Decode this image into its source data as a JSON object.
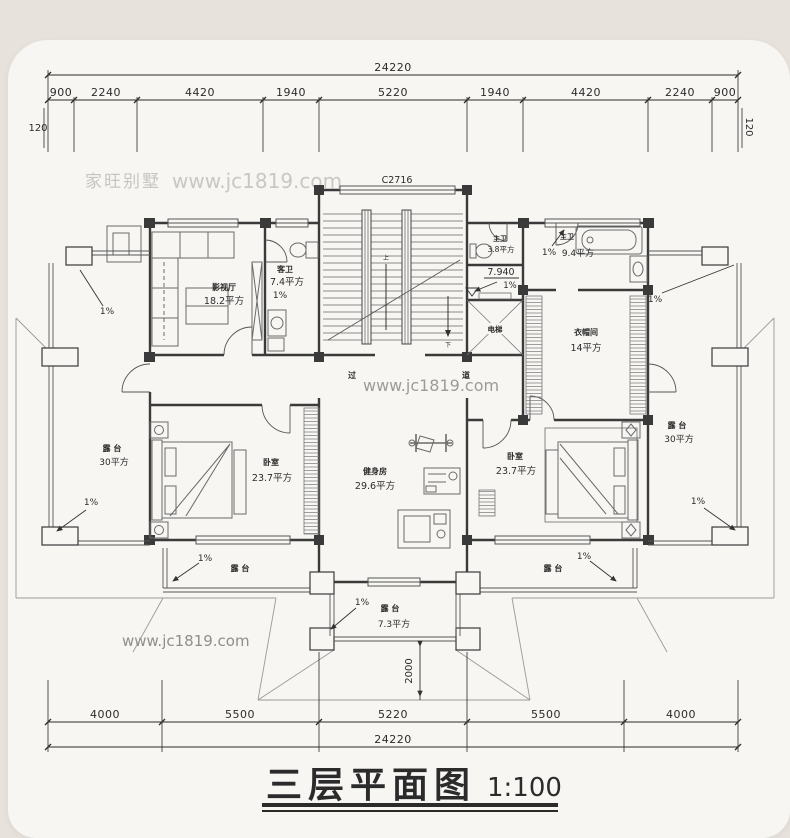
{
  "watermark": {
    "brand": "家旺别墅",
    "site": "www.jc1819.com"
  },
  "top_dims": {
    "total": "24220",
    "segments": [
      "900",
      "2240",
      "4420",
      "1940",
      "5220",
      "1940",
      "4420",
      "2240",
      "900"
    ],
    "edge_left": "120",
    "edge_right": "120"
  },
  "bottom_dims": {
    "total": "24220",
    "segments": [
      "4000",
      "5500",
      "5220",
      "5500",
      "4000"
    ],
    "porch_depth": "2000"
  },
  "plan": {
    "window_label": "C2716",
    "level_mark": "7.940",
    "slope": "1%",
    "stair_up": "上",
    "stair_down": "下",
    "corridor_char_1": "过",
    "corridor_char_2": "道",
    "rooms": {
      "theater": {
        "name": "影视厅",
        "area": "18.2平方"
      },
      "guest_bath": {
        "name": "客卫",
        "area": "7.4平方"
      },
      "small_bath": {
        "name": "主卫",
        "area": "3.8平方"
      },
      "master_bath": {
        "name": "主卫",
        "area": "9.4平方"
      },
      "closet": {
        "name": "衣帽间",
        "area": "14平方"
      },
      "elevator": {
        "name": "电梯"
      },
      "gym": {
        "name": "健身房",
        "area": "29.6平方"
      },
      "bedroom_left": {
        "name": "卧室",
        "area": "23.7平方"
      },
      "bedroom_right": {
        "name": "卧室",
        "area": "23.7平方"
      },
      "terrace_left": {
        "name": "露 台",
        "area": "30平方"
      },
      "terrace_right": {
        "name": "露 台",
        "area": "30平方"
      },
      "terrace_lower_left": {
        "name": "露 台"
      },
      "terrace_lower_right": {
        "name": "露 台"
      },
      "terrace_front": {
        "name": "露 台",
        "area": "7.3平方"
      }
    }
  },
  "title": {
    "text": "三层平面图",
    "scale": "1:100"
  },
  "colors": {
    "wall": "#3a3a3a",
    "dim": "#2b2b2b",
    "card": "#f7f6f3",
    "background": "#e7e3dc"
  }
}
